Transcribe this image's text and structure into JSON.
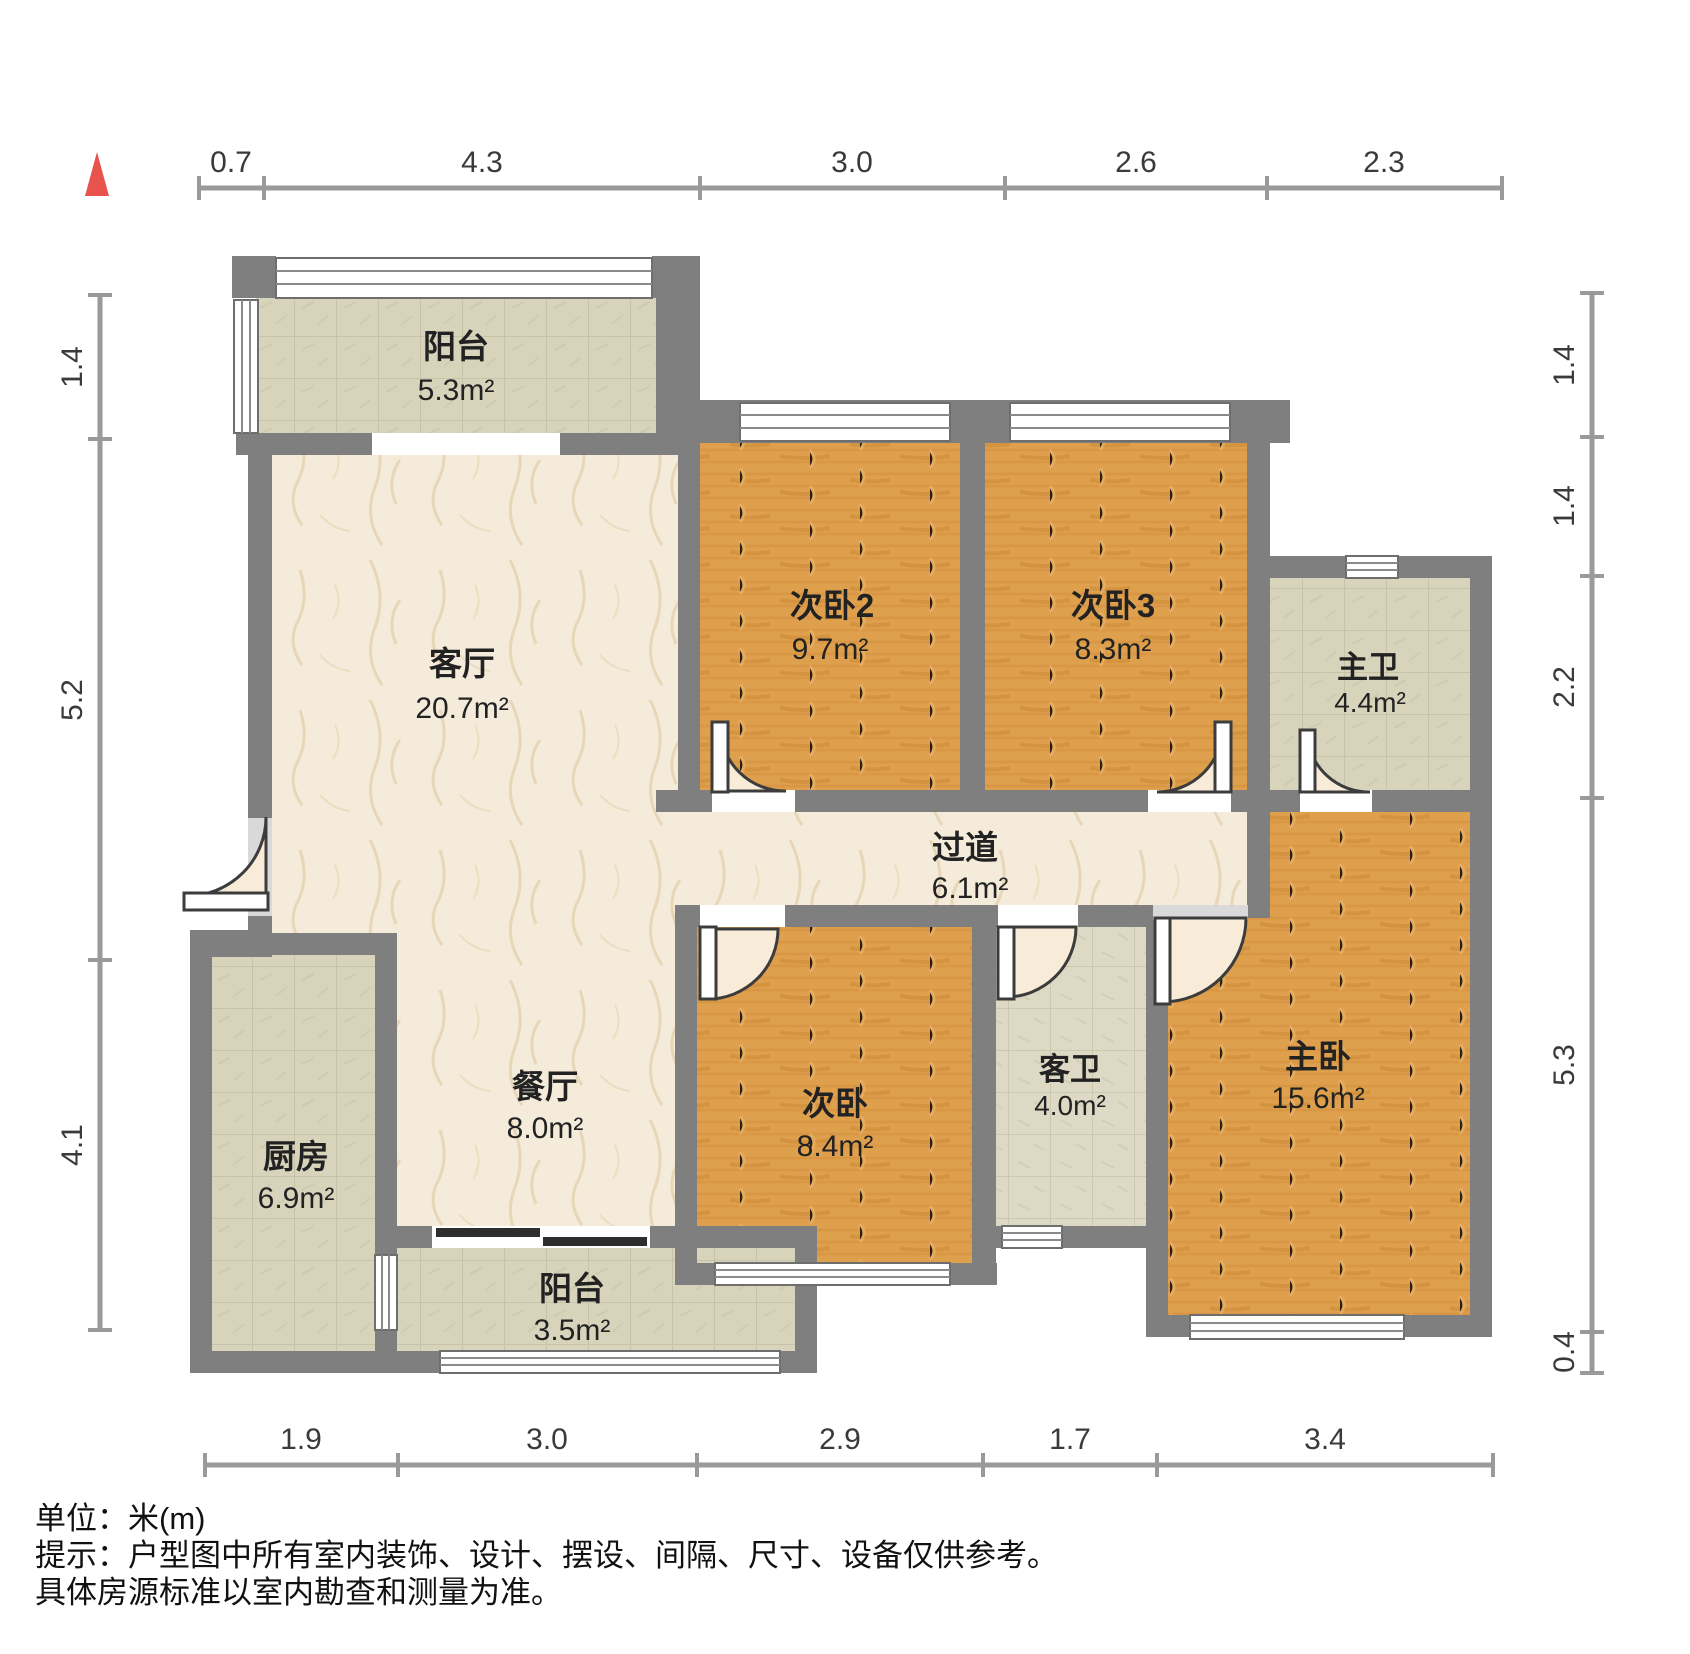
{
  "title": "户型图",
  "north_indicator": "north-triangle",
  "colors": {
    "wall": "#7f7f7f",
    "wood_floor": "#dfa04e",
    "marble_floor": "#f4ebdb",
    "tile_floor": "#d8d4bc",
    "north_red": "#e9534e",
    "dim_line": "#9a9a9a",
    "slider_dark": "#2e2e2e"
  },
  "rooms": [
    {
      "id": "balcony-top",
      "name": "阳台",
      "area": "5.3m²"
    },
    {
      "id": "living-room",
      "name": "客厅",
      "area": "20.7m²"
    },
    {
      "id": "bedroom-2",
      "name": "次卧2",
      "area": "9.7m²"
    },
    {
      "id": "bedroom-3",
      "name": "次卧3",
      "area": "8.3m²"
    },
    {
      "id": "master-bath",
      "name": "主卫",
      "area": "4.4m²"
    },
    {
      "id": "hallway",
      "name": "过道",
      "area": "6.1m²"
    },
    {
      "id": "dining-room",
      "name": "餐厅",
      "area": "8.0m²"
    },
    {
      "id": "bedroom-1",
      "name": "次卧",
      "area": "8.4m²"
    },
    {
      "id": "guest-bath",
      "name": "客卫",
      "area": "4.0m²"
    },
    {
      "id": "master-bed",
      "name": "主卧",
      "area": "15.6m²"
    },
    {
      "id": "kitchen",
      "name": "厨房",
      "area": "6.9m²"
    },
    {
      "id": "balcony-bottom",
      "name": "阳台",
      "area": "3.5m²"
    }
  ],
  "dimensions": {
    "top": [
      "0.7",
      "4.3",
      "3.0",
      "2.6",
      "2.3"
    ],
    "bottom": [
      "1.9",
      "3.0",
      "2.9",
      "1.7",
      "3.4"
    ],
    "left": [
      "1.4",
      "5.2",
      "4.1"
    ],
    "right": [
      "1.4",
      "1.4",
      "2.2",
      "5.3",
      "0.4"
    ]
  },
  "footer": {
    "line1": "单位：米(m)",
    "line2": "提示：户型图中所有室内装饰、设计、摆设、间隔、尺寸、设备仅供参考。",
    "line3": "具体房源标准以室内勘查和测量为准。"
  }
}
